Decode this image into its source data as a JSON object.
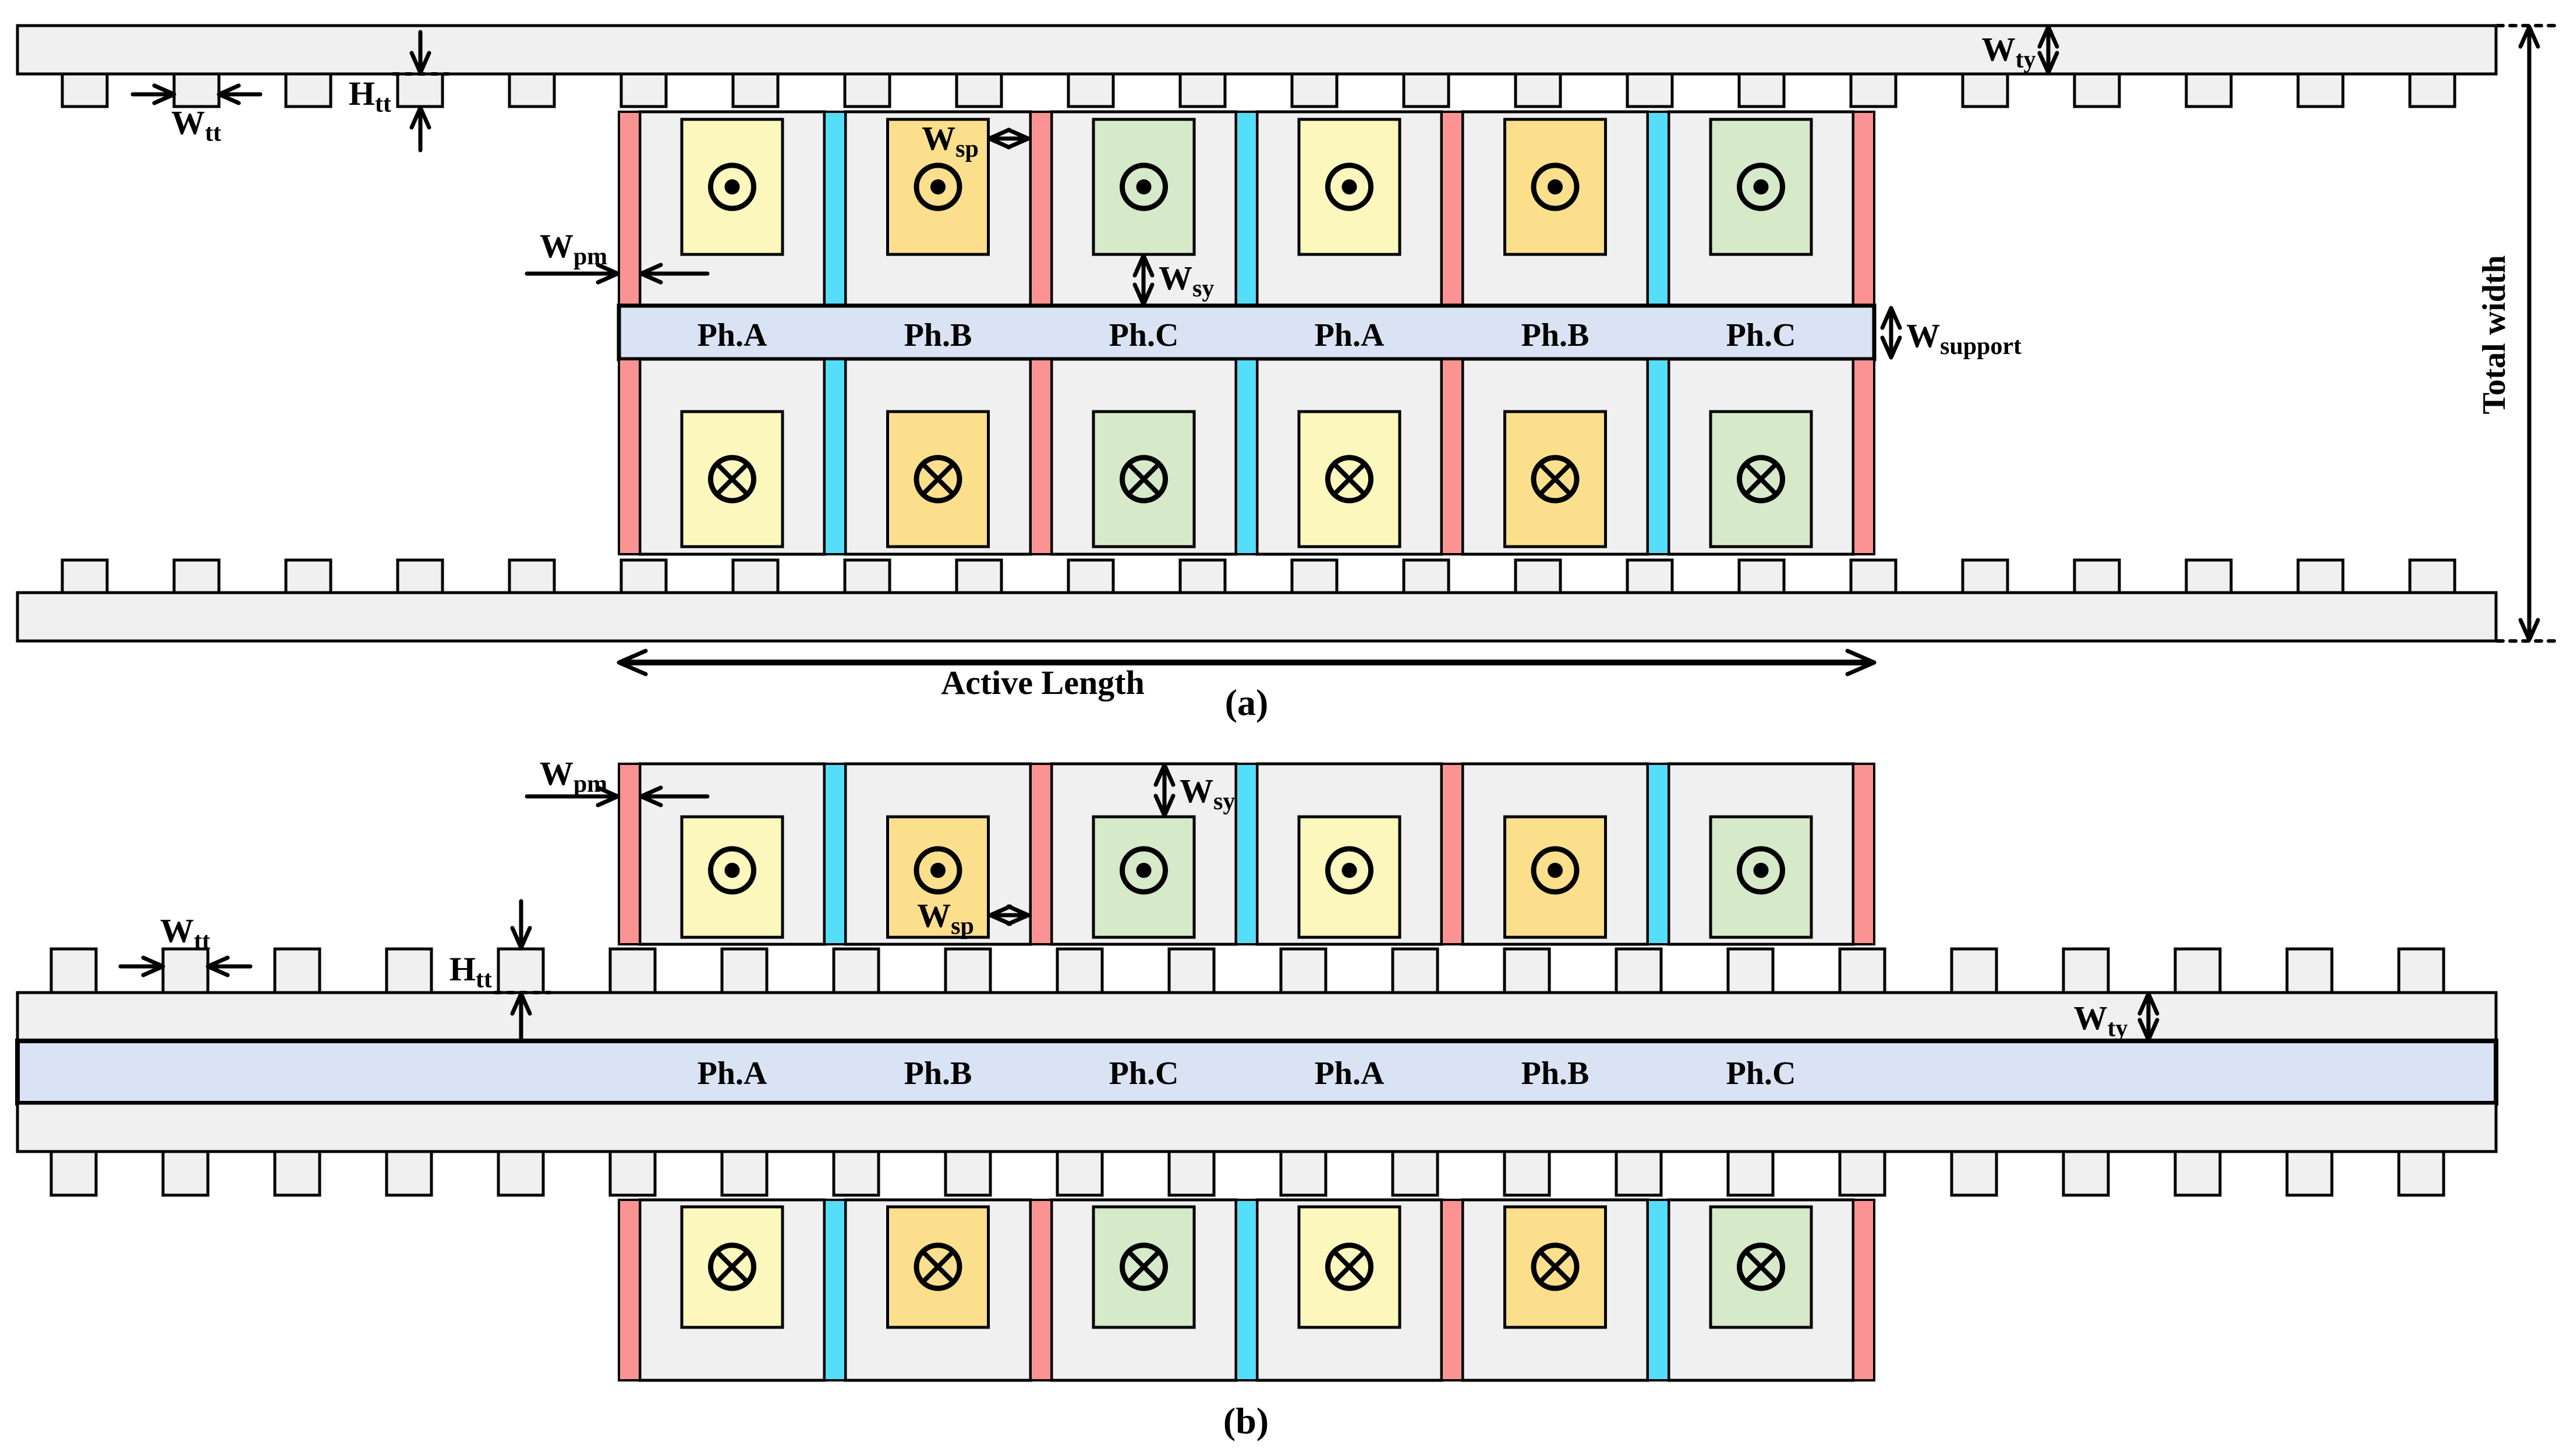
{
  "title": "Linear flux machine topology cross-sections",
  "colors": {
    "background": "#FFFFFF",
    "outline": "#000000",
    "core_gray": "#F0F0F0",
    "magnet_red": "#FB9393",
    "spacer_cyan": "#55DEFA",
    "coil_phase_a_yellow": "#FCF7BD",
    "coil_phase_b_orange": "#FBDF8C",
    "coil_phase_c_green": "#D6E9C8",
    "support_lavender": "#D9E3F4"
  },
  "phases": {
    "sequence": [
      "Ph.A",
      "Ph.B",
      "Ph.C",
      "Ph.A",
      "Ph.B",
      "Ph.C"
    ]
  },
  "symbols": {
    "current_out": "dot-in-circle",
    "current_in": "cross-in-circle"
  },
  "separators": {
    "sequence": [
      "magnet",
      "spacer",
      "magnet",
      "spacer",
      "magnet",
      "spacer",
      "magnet"
    ]
  },
  "dim_labels": {
    "wtt": {
      "main": "W",
      "sub": "tt"
    },
    "htt": {
      "main": "H",
      "sub": "tt"
    },
    "wty": {
      "main": "W",
      "sub": "ty"
    },
    "wpm": {
      "main": "W",
      "sub": "pm"
    },
    "wsp": {
      "main": "W",
      "sub": "sp"
    },
    "wsy": {
      "main": "W",
      "sub": "sy"
    },
    "wsupport": {
      "main": "W",
      "sub": "support"
    }
  },
  "annotations": {
    "active_length": "Active Length",
    "total_width": "Total width"
  },
  "captions": {
    "a": "(a)",
    "b": "(b)"
  }
}
